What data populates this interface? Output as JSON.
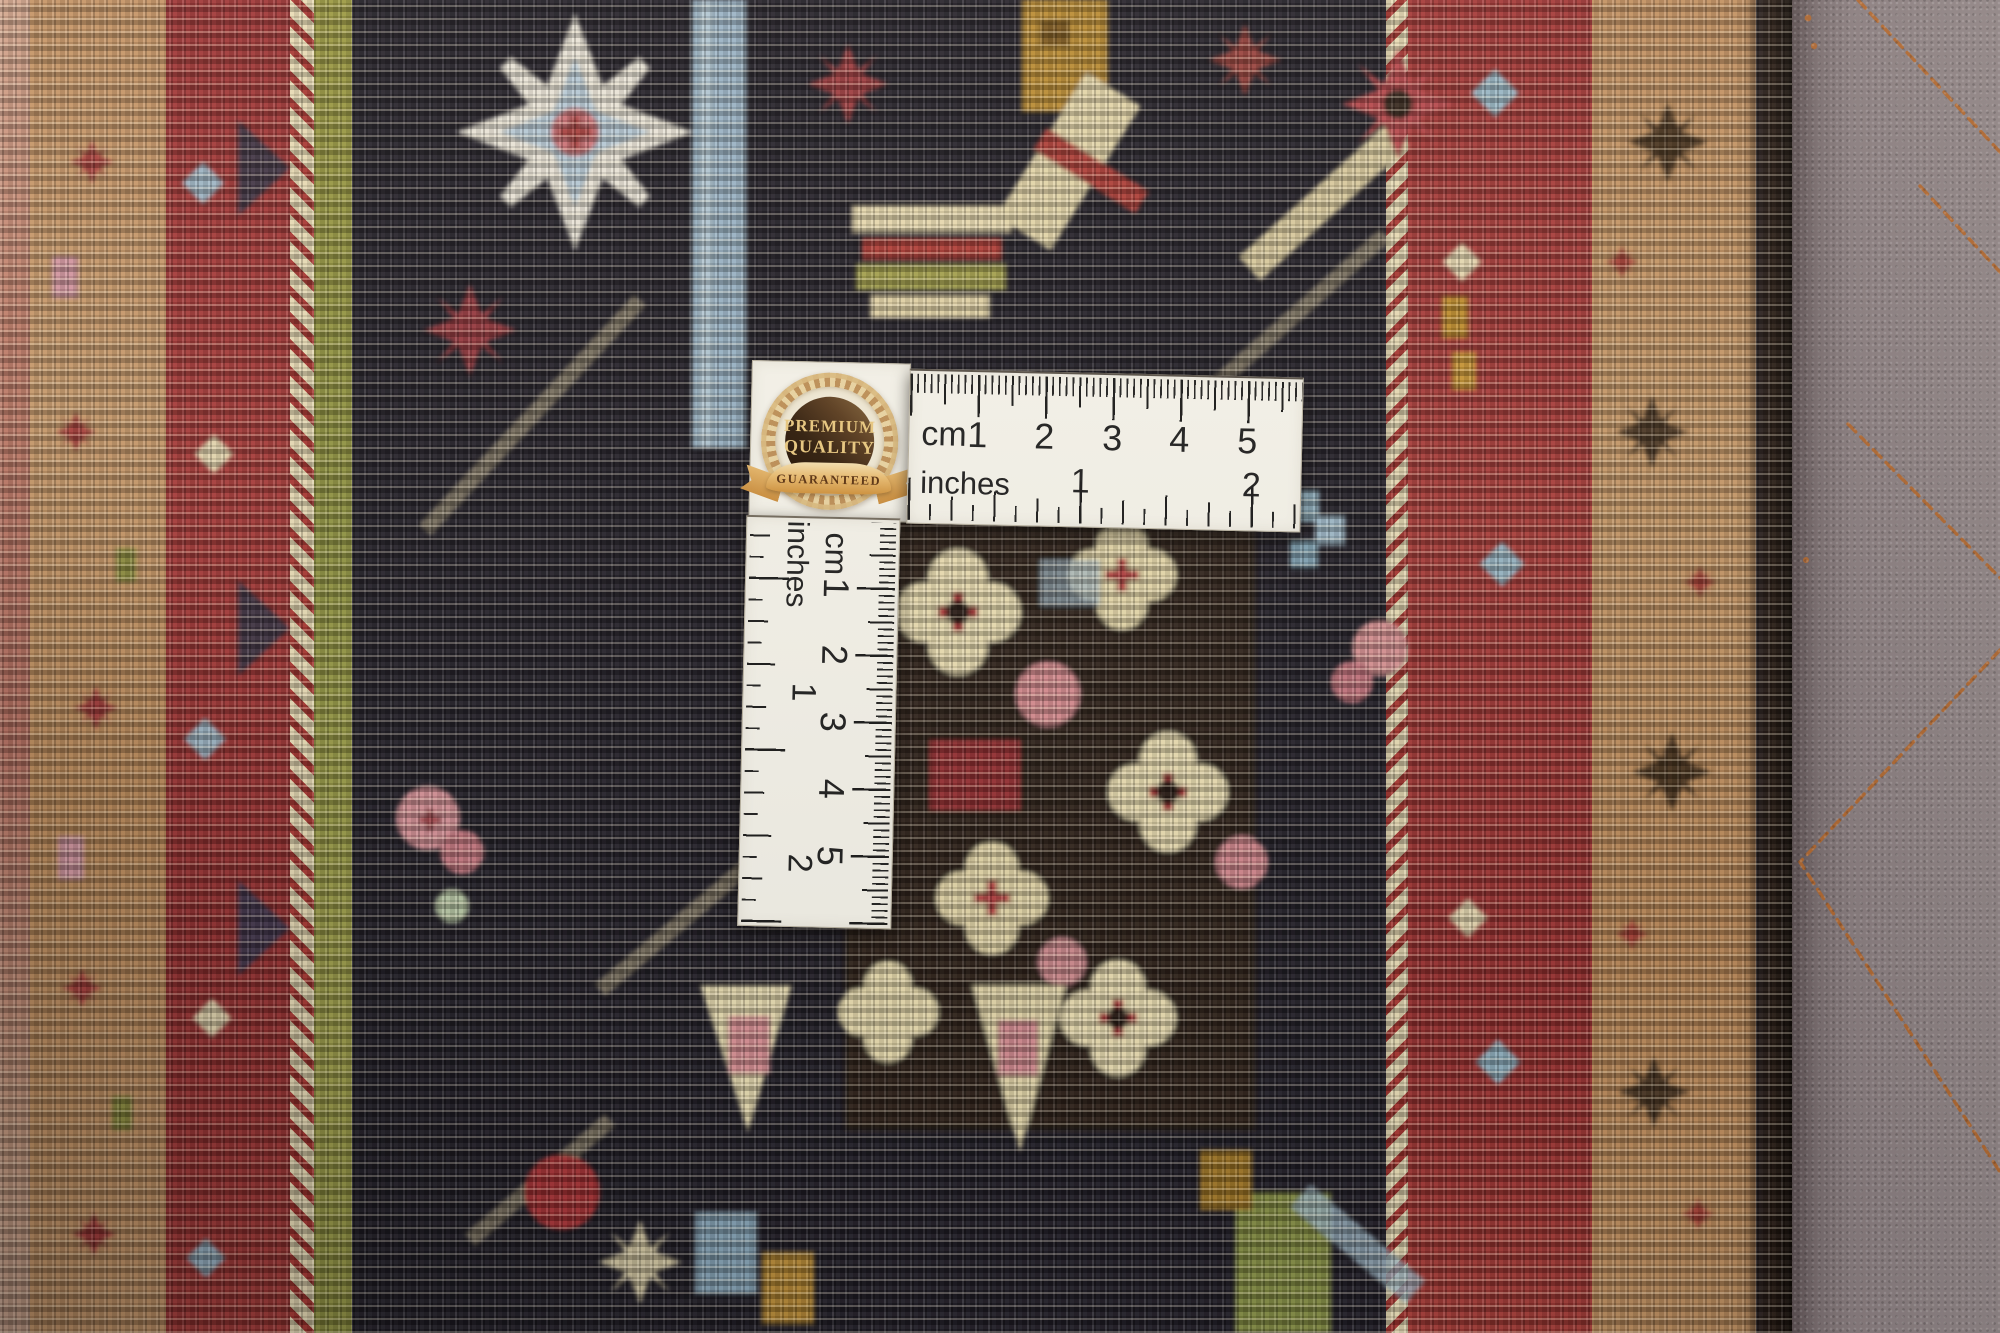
{
  "badge": {
    "premium": "PREMIUM",
    "quality": "QUALITY",
    "guaranteed": "GUARANTEED"
  },
  "ruler_horizontal": {
    "cm_label": "cm",
    "inches_label": "inches",
    "cm_numbers": [
      "1",
      "2",
      "3",
      "4",
      "5"
    ],
    "inch_numbers": [
      "1",
      "2"
    ]
  },
  "ruler_vertical": {
    "cm_label": "cm",
    "inches_label": "inches",
    "cm_numbers": [
      "1",
      "2",
      "3",
      "4",
      "5"
    ],
    "inch_numbers": [
      "1",
      "2"
    ]
  },
  "colors": {
    "ruler_background": "#f7f5ec",
    "tick_black": "#1d1d1d",
    "badge_gold": "#d8ab63",
    "badge_dark_brown": "#33200f",
    "badge_text_gold": "#eccb83",
    "ribbon_text_brown": "#5d3514",
    "leather_taupe": "#8b7f81",
    "stitch_copper": "#b2682f",
    "rug_navy": "#232029",
    "rug_red": "#a83a38",
    "rug_camel": "#c89a6b",
    "rug_cream": "#e7d9ae",
    "rug_light_blue": "#9fb9cc",
    "rug_olive": "#99973f",
    "rug_pink": "#d78e93"
  }
}
